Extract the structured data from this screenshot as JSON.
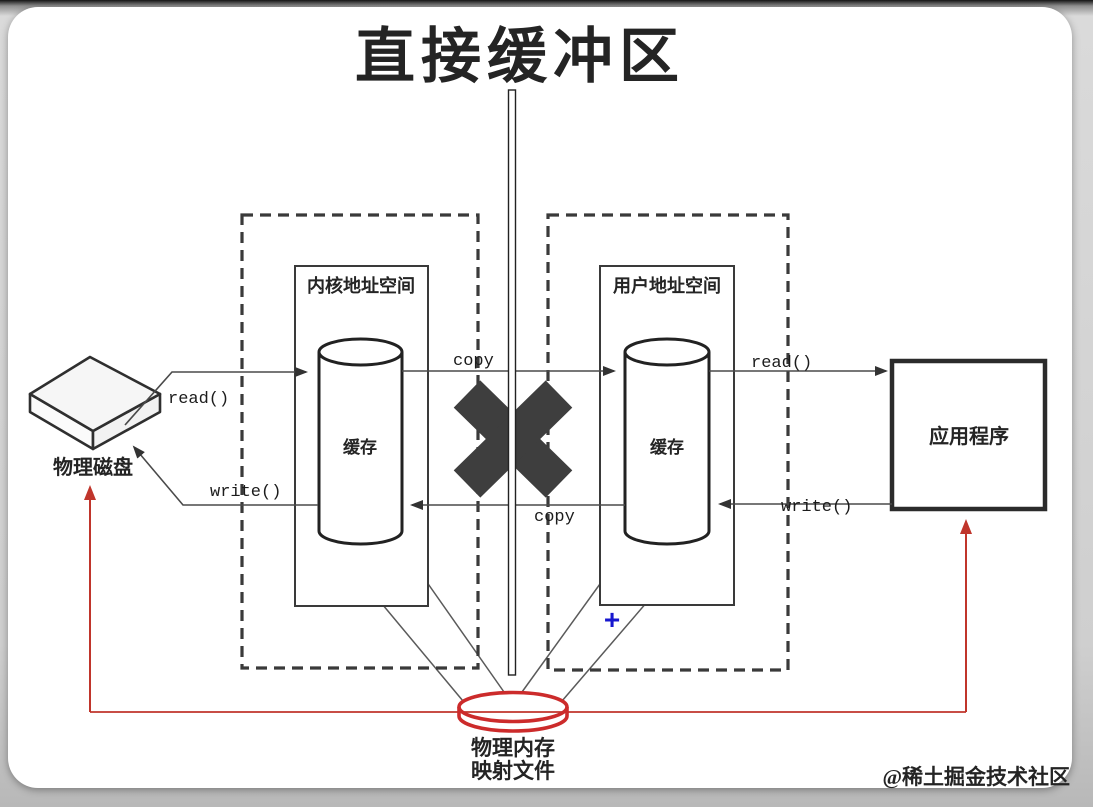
{
  "title": "直接缓冲区",
  "watermark": "@稀土掘金技术社区",
  "physical_disk": {
    "label": "物理磁盘"
  },
  "kernel_space": {
    "label": "内核地址空间",
    "buffer": "缓存"
  },
  "user_space": {
    "label": "用户地址空间",
    "buffer": "缓存"
  },
  "application": {
    "label": "应用程序"
  },
  "mapped_memory": {
    "line1": "物理内存",
    "line2": "映射文件"
  },
  "calls": {
    "disk_read": "read()",
    "disk_write": "write()",
    "copy_to_user": "copy",
    "copy_to_kernel": "copy",
    "app_read": "read()",
    "app_write": "write()"
  },
  "cursor_glyph": "+",
  "colors": {
    "line": "#4a4a4a",
    "box": "#2d2d2d",
    "cross_mark": "#3e3e3e",
    "red": "#c0352b",
    "blue": "#1717cf",
    "watermark": "#c9c9c9"
  }
}
